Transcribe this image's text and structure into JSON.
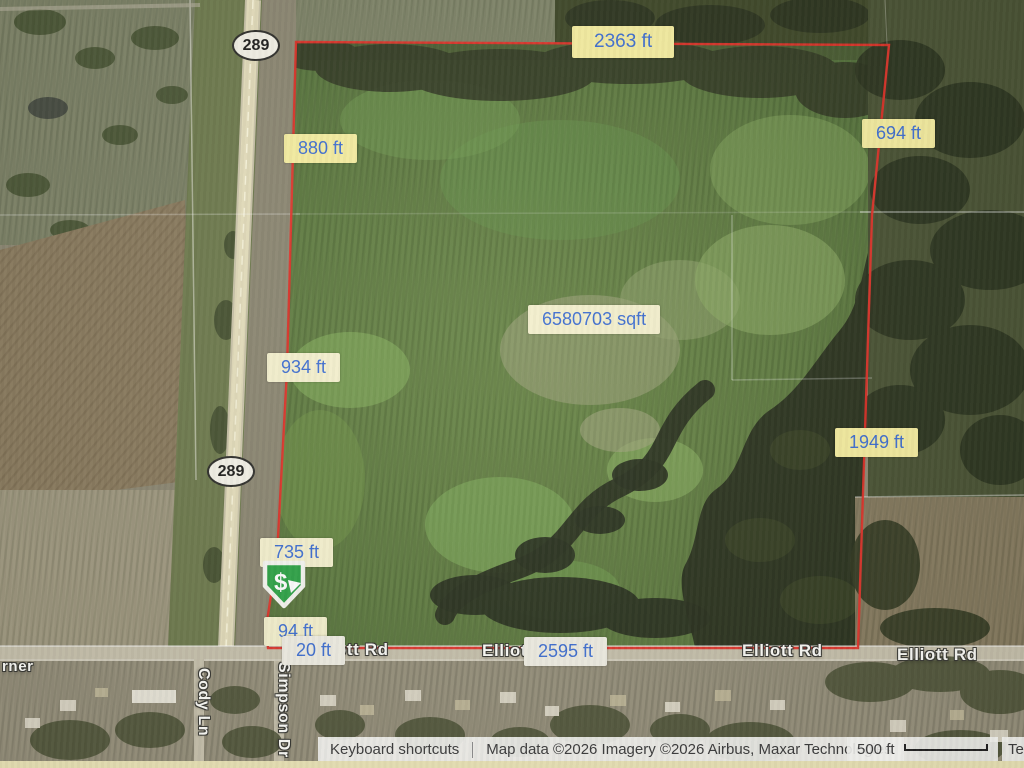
{
  "map": {
    "measurements": [
      {
        "id": "top-edge",
        "text": "2363 ft"
      },
      {
        "id": "right-upper",
        "text": "694 ft"
      },
      {
        "id": "left-upper",
        "text": "880 ft"
      },
      {
        "id": "left-middle",
        "text": "934 ft"
      },
      {
        "id": "right-lower",
        "text": "1949 ft"
      },
      {
        "id": "left-lower",
        "text": "735 ft"
      },
      {
        "id": "left-bottom-1",
        "text": "94 ft"
      },
      {
        "id": "left-bottom-2",
        "text": "20 ft"
      },
      {
        "id": "bottom-edge",
        "text": "2595 ft"
      }
    ],
    "area_label": "6580703 sqft",
    "road_labels": [
      {
        "id": "elliott-west",
        "text": "Elliott Rd"
      },
      {
        "id": "elliott-center",
        "text": "Elliott Rd"
      },
      {
        "id": "elliott-east",
        "text": "Elliott Rd"
      },
      {
        "id": "elliott-far-east",
        "text": "Elliott Rd"
      },
      {
        "id": "cody-ln",
        "text": "Cody Ln"
      },
      {
        "id": "simpson-dr",
        "text": "Simpson Dr"
      },
      {
        "id": "partial-left-edge",
        "text": "rner"
      }
    ],
    "route_shield": "289"
  },
  "statusbar": {
    "keyboard_shortcuts": "Keyboard shortcuts",
    "attribution": "Map data ©2026 Imagery ©2026 Airbus, Maxar Technologies",
    "scale_text": "500 ft",
    "terms_partial": "Te"
  },
  "colors": {
    "boundary_red": "#e03228",
    "label_text_blue": "#3f6fd1",
    "label_bg_yellow": "#f5eda0",
    "marker_green": "#2fa347"
  }
}
